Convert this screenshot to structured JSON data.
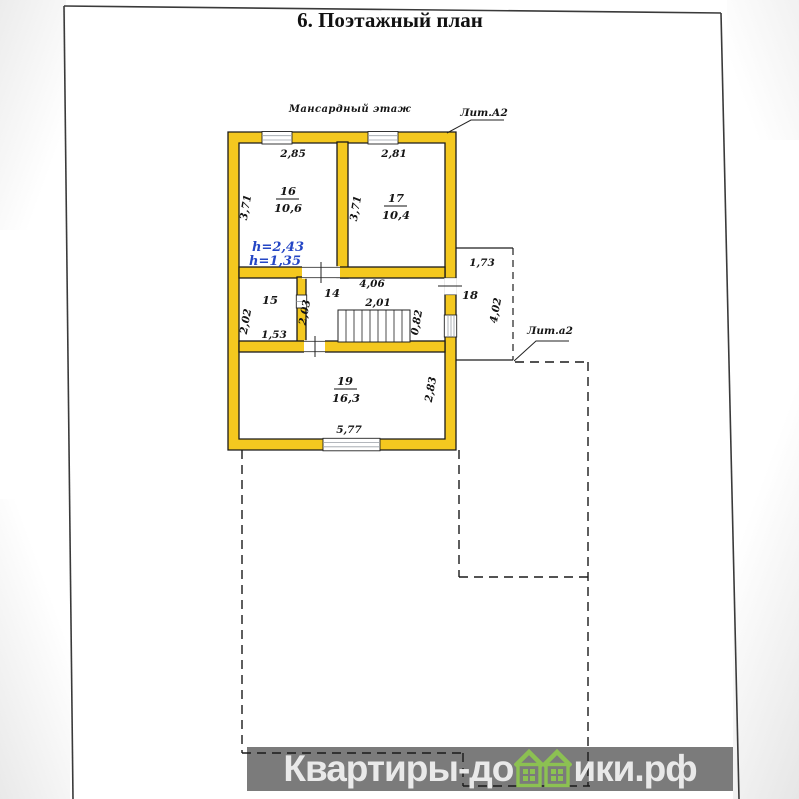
{
  "title": "6. Поэтажный план",
  "plan": {
    "floor_label": "Мансардный этаж",
    "lit_main": "Лит.А2",
    "lit_annex": "Лит.а2",
    "height_note_1": "h=2,43",
    "height_note_2": "h=1,35",
    "room16": {
      "num": "16",
      "area": "10,6",
      "width": "2,85",
      "depth": "3,71"
    },
    "room17": {
      "num": "17",
      "area": "10,4",
      "width": "2,81",
      "depth": "3,71"
    },
    "room15": {
      "num": "15",
      "width": "1,53",
      "depth": "2,02"
    },
    "room14": {
      "num": "14",
      "width": "4,06",
      "depth": "2,03",
      "stair_width": "2,01",
      "stair_depth": "0,82"
    },
    "room18": {
      "num": "18",
      "width": "1,73",
      "depth": "4,02"
    },
    "room19": {
      "num": "19",
      "area": "16,3",
      "width": "5,77",
      "depth": "2,83"
    }
  },
  "watermark": {
    "left": "Квартиры-до",
    "right": "ики.рф"
  },
  "colors": {
    "wall_fill": "#F4C81F",
    "line": "#1A1A1A",
    "height_note_blue": "#2446C5",
    "watermark_bar": "#7B7B7B",
    "watermark_text": "#E9E9E9",
    "watermark_house_green": "#8CC152"
  }
}
